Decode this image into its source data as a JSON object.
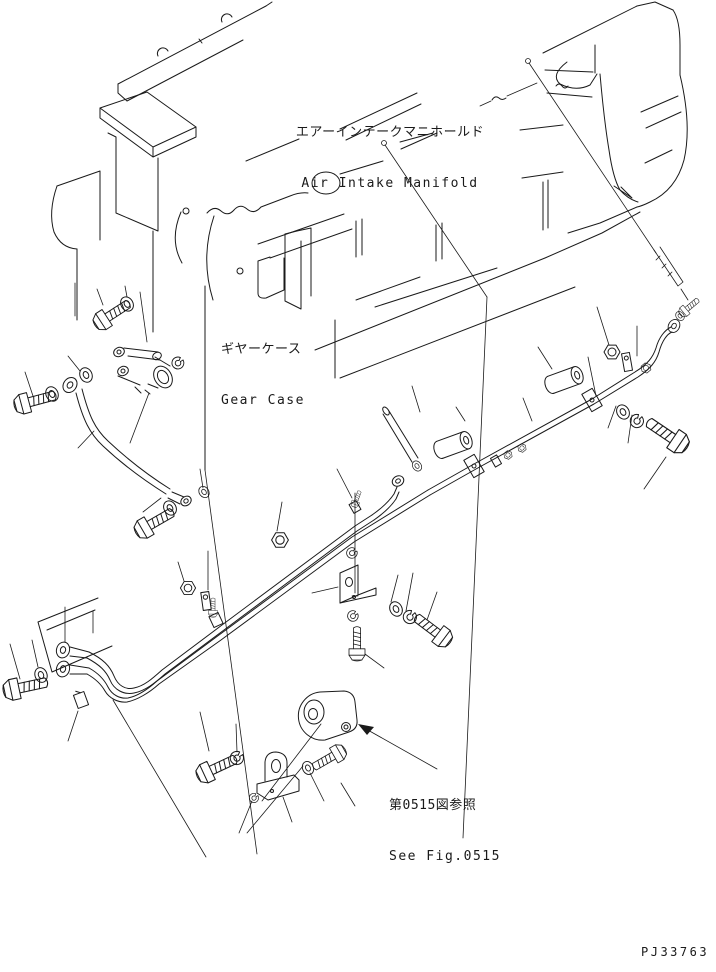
{
  "figure": {
    "type": "engine-parts-exploded-diagram",
    "drawing_number": "PJ33763",
    "callouts": {
      "air_intake_manifold": {
        "jp": "エアーインテークマニホールド",
        "en": "Air Intake Manifold"
      },
      "gear_case": {
        "jp": "ギヤーケース",
        "en": "Gear Case"
      },
      "reference": {
        "jp": "第0515図参照",
        "en": "See Fig.0515"
      }
    },
    "colors": {
      "ink": "#1a1a1a",
      "paper": "#ffffff"
    }
  }
}
